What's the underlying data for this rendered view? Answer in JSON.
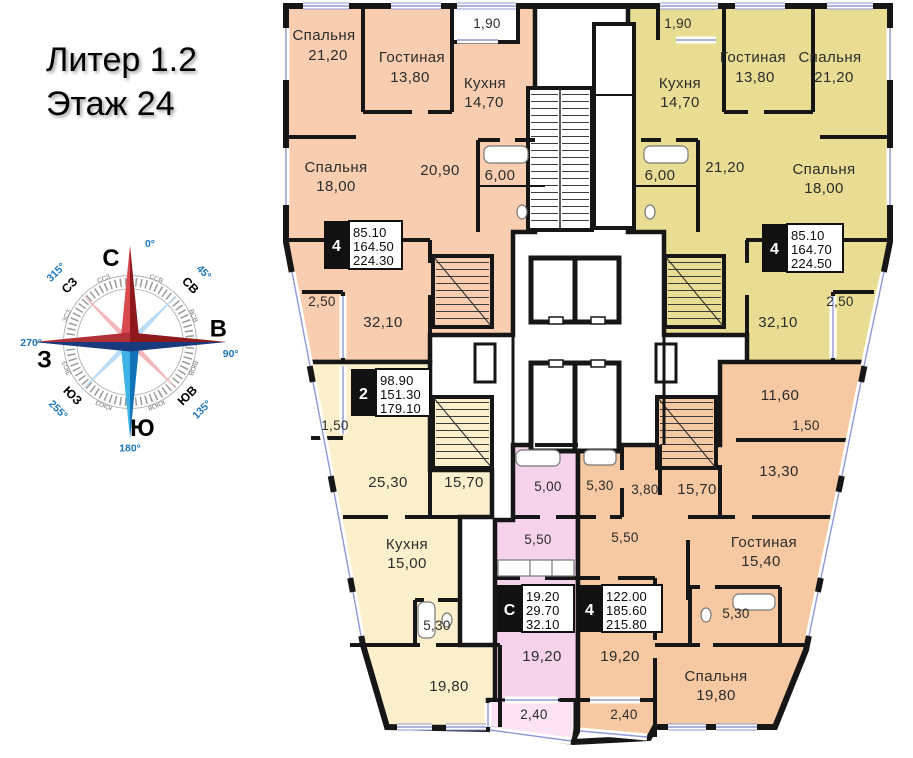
{
  "header": {
    "line1": "Литер 1.2",
    "line2": "Этаж 24"
  },
  "compass": {
    "cardinals": [
      {
        "label": "С",
        "deg": "0°"
      },
      {
        "label": "В",
        "deg": "90°"
      },
      {
        "label": "Ю",
        "deg": "180°"
      },
      {
        "label": "З",
        "deg": "270°"
      }
    ],
    "intercardinals": [
      {
        "label": "СВ",
        "deg": "45°"
      },
      {
        "label": "ЮВ",
        "deg": "135°"
      },
      {
        "label": "ЮЗ",
        "deg": "255°"
      },
      {
        "label": "СЗ",
        "deg": "315°"
      }
    ],
    "ring": [
      "ССВ",
      "ВСВ",
      "ВЮВ",
      "ЮЮВ",
      "ЮЮЗ",
      "ЗЮЗ",
      "ЗСЗ",
      "ССЗ"
    ]
  },
  "apartments": [
    {
      "key": "apt-4room-top-left",
      "badge": "4",
      "stats": [
        "85.10",
        "164.50",
        "224.30"
      ],
      "rooms": [
        {
          "name": "Спальня",
          "area": "21,20"
        },
        {
          "name": "Гостиная",
          "area": "13,80"
        },
        {
          "area": "1,90"
        },
        {
          "name": "Кухня",
          "area": "14,70"
        },
        {
          "name": "Спальня",
          "area": "18,00"
        },
        {
          "area": "20,90"
        },
        {
          "area": "6,00"
        },
        {
          "area": "2,50"
        },
        {
          "area": "32,10"
        }
      ]
    },
    {
      "key": "apt-4room-top-right",
      "badge": "4",
      "stats": [
        "85.10",
        "164.70",
        "224.50"
      ],
      "rooms": [
        {
          "area": "1,90"
        },
        {
          "name": "Кухня",
          "area": "14,70"
        },
        {
          "name": "Гостиная",
          "area": "13,80"
        },
        {
          "name": "Спальня",
          "area": "21,20"
        },
        {
          "area": "21,20"
        },
        {
          "name": "Спальня",
          "area": "18,00"
        },
        {
          "area": "6,00"
        },
        {
          "area": "2,50"
        },
        {
          "area": "32,10"
        }
      ]
    },
    {
      "key": "apt-2room-left",
      "badge": "2",
      "stats": [
        "98.90",
        "151.30",
        "179.10"
      ],
      "rooms": [
        {
          "area": "1,50"
        },
        {
          "area": "25,30"
        },
        {
          "area": "15,70"
        },
        {
          "name": "Кухня",
          "area": "15,00"
        },
        {
          "area": "5,30"
        },
        {
          "area": "19,80"
        }
      ]
    },
    {
      "key": "apt-studio",
      "badge": "С",
      "stats": [
        "19.20",
        "29.70",
        "32.10"
      ],
      "rooms": [
        {
          "area": "5,00"
        },
        {
          "area": "5,50"
        },
        {
          "area": "19,20"
        },
        {
          "area": "2,40"
        }
      ]
    },
    {
      "key": "apt-4room-bottom-right",
      "badge": "4",
      "stats": [
        "122.00",
        "185.60",
        "215.80"
      ],
      "rooms": [
        {
          "area": "5,30"
        },
        {
          "area": "3,80"
        },
        {
          "area": "15,70"
        },
        {
          "area": "5,50"
        },
        {
          "area": "11,60"
        },
        {
          "area": "1,50"
        },
        {
          "area": "13,30"
        },
        {
          "name": "Гостиная",
          "area": "15,40"
        },
        {
          "area": "5,30"
        },
        {
          "name": "Спальня",
          "area": "19,80"
        },
        {
          "area": "19,20"
        },
        {
          "area": "2,40"
        }
      ]
    }
  ],
  "colors": {
    "apt_top_left": "#f8cdb0",
    "apt_top_right": "#e9dd94",
    "apt_2room": "#fcf0cc",
    "apt_studio": "#f6d3eb",
    "apt_studio_balcony": "#fbe3f3",
    "apt_bottom_right": "#f7c9a2",
    "wall": "#161616",
    "window": "#8f98d4",
    "badge_bg": "#111111",
    "compass_red": "#8e181c",
    "compass_red_light": "#d94a4e",
    "compass_blue": "#1a3a7e",
    "compass_blue_light": "#3fb3e8",
    "degree_blue": "#1b75bc"
  }
}
